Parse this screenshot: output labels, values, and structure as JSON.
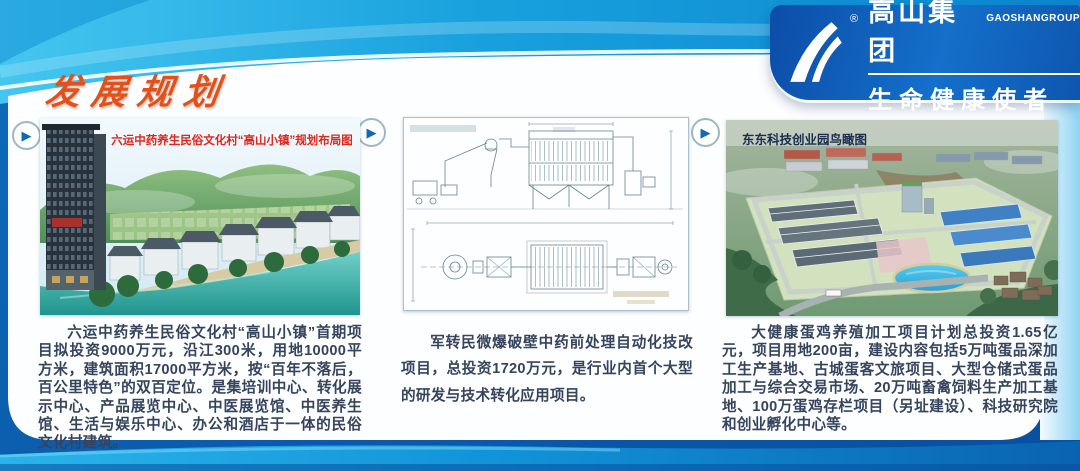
{
  "brand": {
    "company_name": "高山集团",
    "company_name_en": "GAOSHANGROUP",
    "slogan": "生命健康使者",
    "registered_mark": "®",
    "logo_icon": "gaoshan-mountain-mark",
    "panel_color": "#1266c2"
  },
  "page": {
    "title": "发展规划",
    "title_color": "#e2511c"
  },
  "icons": {
    "panel_arrow": "▶"
  },
  "panels": [
    {
      "caption": "六运中药养生民俗文化村“高山小镇”规划布局图",
      "image": "riverside-folk-culture-village-rendering",
      "description": "六运中药养生民俗文化村“高山小镇”首期项目拟投资9000万元，沿江300米，用地10000平方米，建筑面积17000平方米，按“百年不落后，百公里特色”的双百定位。是集培训中心、转化展示中心、产品展览中心、中医展览馆、中医养生馆、生活与娱乐中心、办公和酒店于一体的民俗文化村建筑。"
    },
    {
      "caption": "",
      "image": "equipment-technical-drawing",
      "description": "军转民微爆破壁中药前处理自动化技改项目，总投资1720万元，是行业内首个大型的研发与技术转化应用项目。"
    },
    {
      "caption": "东东科技创业园鸟瞰图",
      "image": "science-park-aerial-rendering",
      "description": "大健康蛋鸡养殖加工项目计划总投资1.65亿元，项目用地200亩，建设内容包括5万吨蛋品深加工生产基地、古城蛋客文旅项目、大型仓储式蛋品加工与综合交易市场、20万吨畜禽饲料生产加工基地、100万蛋鸡存栏项目（另址建设）、科技研究院和创业孵化中心等。"
    }
  ],
  "colors": {
    "top_band": "#18a0dd",
    "deep_blue": "#0a58a8",
    "caption_red": "#e0251a",
    "body_text": "#36435d"
  }
}
